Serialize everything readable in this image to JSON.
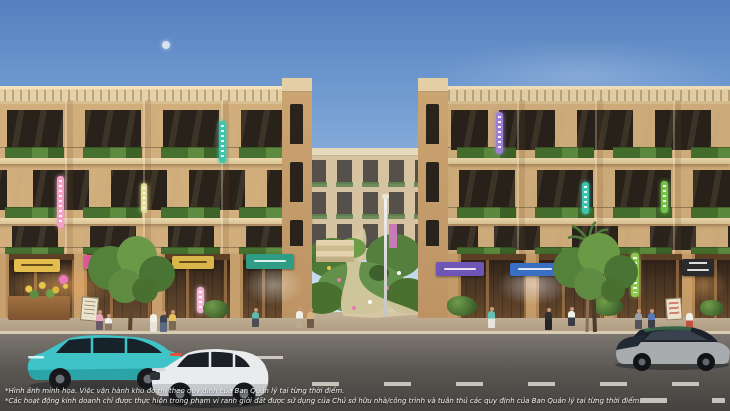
{
  "disclaimer": {
    "line1": "*Hình ảnh minh họa. Việc vận hành khu đô thị theo quy định của Ban Quản lý tại từng thời điểm.",
    "line2": "*Các hoạt động kinh doanh chỉ được thực hiện trong phạm vi ranh giới đất được sử dụng của Chủ sở hữu nhà/công trình và tuân thủ các quy định của Ban Quản lý tại từng thời điểm."
  },
  "palette": {
    "sky_top": "#567fbe",
    "sky_horizon": "#eef3f5",
    "facade": "#d2ae7d",
    "parapet": "#e6d2a8",
    "window_glass": "#28221b",
    "storefront_wood": "#4d3825",
    "balcony_greenery": "#46702f",
    "sidewalk": "#b5a38a",
    "road": "#5b5753",
    "lane_marking": "#ddd8d0"
  },
  "storefront_signs": [
    {
      "id": "yellow-sign-1",
      "color": "#e3bc4e"
    },
    {
      "id": "pink-sign",
      "color": "#e0569a"
    },
    {
      "id": "yellow-sign-2",
      "color": "#d9b54a"
    },
    {
      "id": "teal-sign",
      "color": "#2f9c85"
    },
    {
      "id": "purple-sign",
      "color": "#6f55b5"
    },
    {
      "id": "blue-sign",
      "color": "#3a6ec2"
    },
    {
      "id": "lime-sign",
      "color": "#7dc24e"
    },
    {
      "id": "dark-sign",
      "color": "#2b2b2d"
    }
  ],
  "neon_vertical_signs": [
    {
      "id": "pink-neon",
      "color": "#f2a0c4"
    },
    {
      "id": "pale-yellow-neon",
      "color": "#e6e09a"
    },
    {
      "id": "teal-neon-left",
      "color": "#3fc4ae"
    },
    {
      "id": "pale-pink-neon",
      "color": "#f0b6d4"
    },
    {
      "id": "purple-neon",
      "color": "#9d7fd6"
    },
    {
      "id": "teal-neon-right",
      "color": "#3fc4ae"
    },
    {
      "id": "green-neon",
      "color": "#74c24a"
    },
    {
      "id": "lime-neon",
      "color": "#8cc84e"
    }
  ],
  "vehicles": [
    {
      "id": "teal-suv",
      "body_color": "#3fc3c6",
      "direction": "left"
    },
    {
      "id": "white-suv",
      "body_color": "#e9ebec",
      "direction": "left"
    },
    {
      "id": "dark-two-tone-suv",
      "body_color": "#20262e",
      "direction": "left"
    }
  ]
}
